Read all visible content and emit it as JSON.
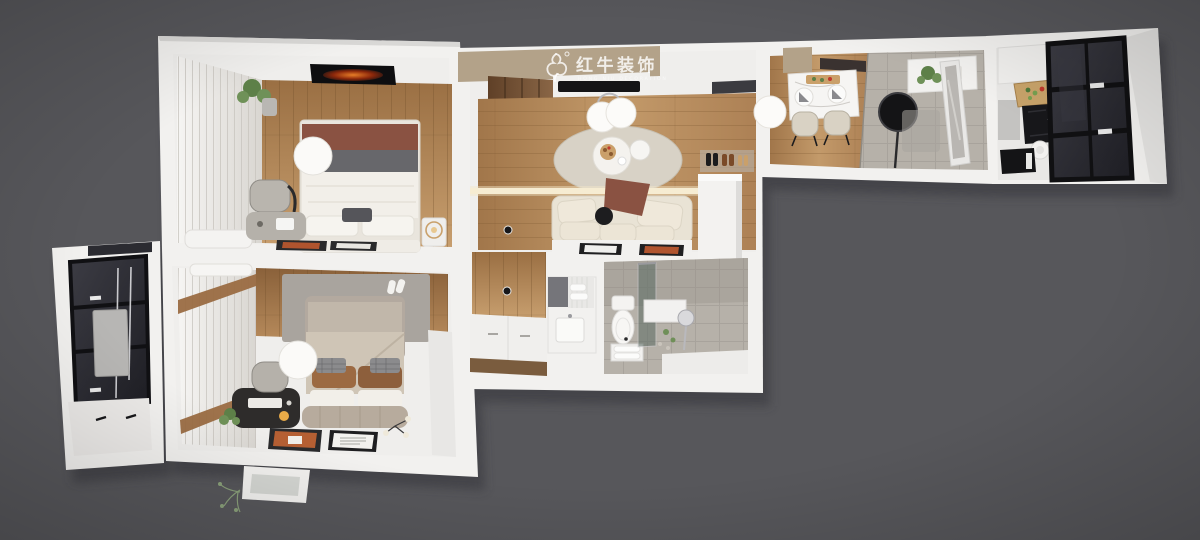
{
  "watermark": {
    "brand": "红牛装饰",
    "tagline": "HONG NIU DECORATION",
    "registered_mark": "®"
  },
  "palette": {
    "bg": "#57575b",
    "wall": "#f2f1ef",
    "wall_shade": "#d9d8d6",
    "soffit_tan": "#b3a289",
    "wood_light": "#c49a69",
    "wood_mid": "#a87c50",
    "wood_dark": "#6b4a2e",
    "tile": "#b6b1a9",
    "glass_dark": "#2b2b31",
    "frame_black": "#141416",
    "sofa_cream": "#e9e3d5",
    "rug_beige": "#d8d2c6",
    "rug_gray": "#a9a49e",
    "throw_brown": "#8a5242",
    "accent_orange": "#b55f33",
    "plant_green": "#5d8048",
    "linen_white": "#f2efe9",
    "watermark_white": "#ffffff"
  }
}
